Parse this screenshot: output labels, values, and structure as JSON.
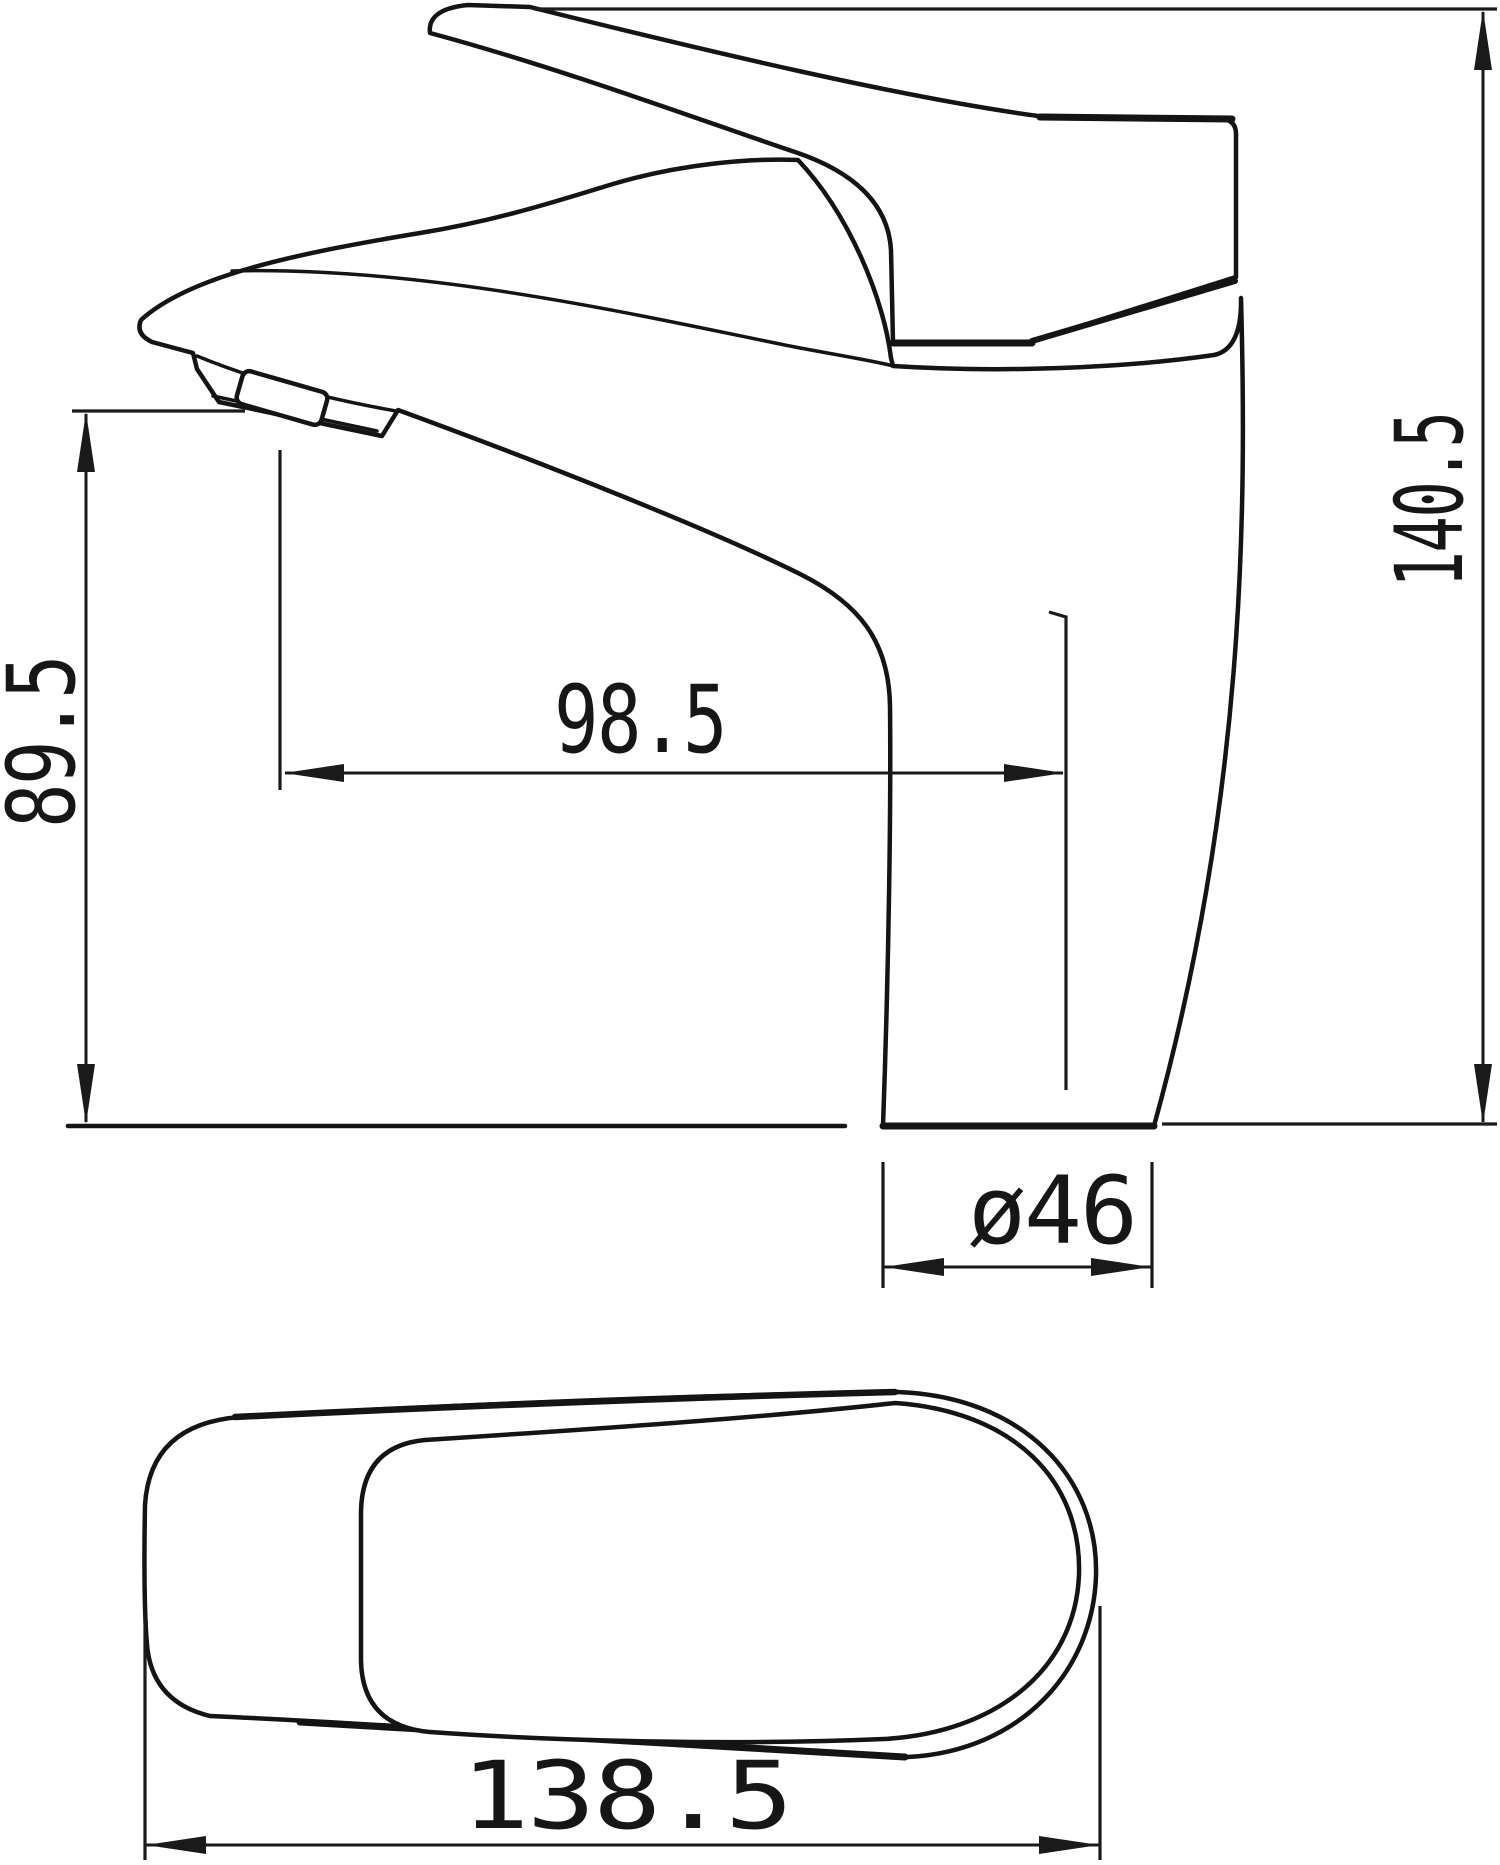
{
  "page": {
    "background": "#ffffff",
    "line_color": "#141414",
    "kind": "technical dimension drawing of single-lever basin faucet"
  },
  "views": {
    "side_view": {
      "name": "faucet side elevation"
    },
    "top_view": {
      "name": "faucet plan view"
    }
  },
  "dimensions": {
    "overall_height": {
      "label": "140.5",
      "orientation": "vertical-right"
    },
    "spout_height": {
      "label": "89.5",
      "orientation": "vertical-left"
    },
    "spout_reach": {
      "label": "98.5",
      "orientation": "horizontal-middle"
    },
    "base_diameter": {
      "label": "ø46",
      "orientation": "horizontal-below-base"
    },
    "overall_length": {
      "label": "138.5",
      "orientation": "horizontal-bottom"
    }
  }
}
